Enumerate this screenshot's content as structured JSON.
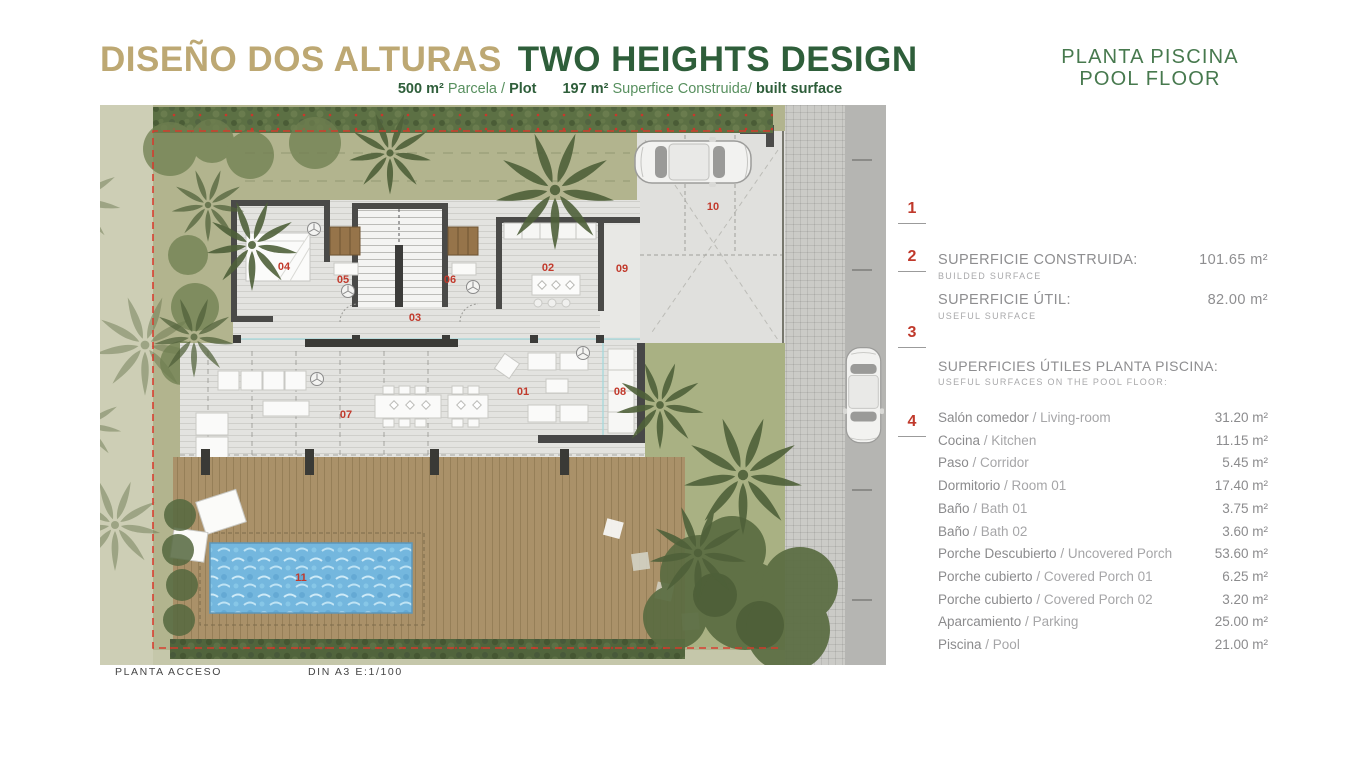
{
  "header": {
    "title_es": "DISEÑO DOS ALTURAS",
    "title_en": "TWO HEIGHTS DESIGN",
    "subtitle": {
      "plot_value": "500 m²",
      "plot_label": "Parcela /",
      "plot_label_en": "Plot",
      "built_value": "197 m²",
      "built_label": "Superfice Construida/",
      "built_label_en": "built surface"
    }
  },
  "side_header": {
    "line1": "PLANTA PISCINA",
    "line2": "POOL FLOOR"
  },
  "markers": [
    "1",
    "2",
    "3",
    "4"
  ],
  "panel": {
    "separator": " / ",
    "summary": [
      {
        "label": "SUPERFICIE CONSTRUIDA:",
        "sublabel": "BUILDED SURFACE",
        "value": "101.65 m²"
      },
      {
        "label": "SUPERFICIE ÚTIL:",
        "sublabel": "USEFUL SURFACE",
        "value": "82.00 m²"
      }
    ],
    "section": {
      "title": "SUPERFICIES ÚTILES PLANTA PISCINA:",
      "subtitle": "USEFUL SURFACES ON THE POOL FLOOR:"
    },
    "rooms": [
      {
        "es": "Salón comedor",
        "en": "Living-room",
        "value": "31.20 m²"
      },
      {
        "es": "Cocina",
        "en": "Kitchen",
        "value": "11.15 m²"
      },
      {
        "es": "Paso",
        "en": "Corridor",
        "value": "5.45 m²"
      },
      {
        "es": "Dormitorio",
        "en": "Room 01",
        "value": "17.40 m²"
      },
      {
        "es": "Baño",
        "en": "Bath 01",
        "value": "3.75 m²"
      },
      {
        "es": "Baño",
        "en": "Bath 02",
        "value": "3.60 m²"
      },
      {
        "es": "Porche Descubierto",
        "en": "Uncovered Porch",
        "value": "53.60 m²"
      },
      {
        "es": "Porche cubierto",
        "en": "Covered Porch 01",
        "value": "6.25 m²"
      },
      {
        "es": "Porche cubierto",
        "en": "Covered Porch 02",
        "value": "3.20 m²"
      },
      {
        "es": "Aparcamiento",
        "en": "Parking",
        "value": "25.00 m²"
      },
      {
        "es": "Piscina",
        "en": "Pool",
        "value": "21.00 m²"
      }
    ]
  },
  "plan": {
    "caption_left": "PLANTA ACCESO",
    "caption_right": "DIN A3  E:1/100",
    "room_numbers": [
      {
        "n": "01",
        "x": 423,
        "y": 290
      },
      {
        "n": "02",
        "x": 448,
        "y": 166
      },
      {
        "n": "03",
        "x": 315,
        "y": 216
      },
      {
        "n": "04",
        "x": 184,
        "y": 165
      },
      {
        "n": "05",
        "x": 243,
        "y": 178
      },
      {
        "n": "06",
        "x": 350,
        "y": 178
      },
      {
        "n": "07",
        "x": 246,
        "y": 313
      },
      {
        "n": "08",
        "x": 520,
        "y": 290
      },
      {
        "n": "09",
        "x": 522,
        "y": 167
      },
      {
        "n": "10",
        "x": 613,
        "y": 105
      },
      {
        "n": "11",
        "x": 201,
        "y": 476
      }
    ]
  },
  "colors": {
    "title_tan": "#bda873",
    "title_green": "#2e5e3a",
    "subtitle_green": "#58905f",
    "side_title_green": "#47794e",
    "marker_red": "#c0392b",
    "plan_number_red": "#c23a2c",
    "panel_gray": "#8e8e90",
    "boundary_red": "#d8392b",
    "lawn_green": "#b2b48e",
    "hedge_green": "#5c7044",
    "deck_brown": "#aa9169",
    "pool_blue": "#74b7de",
    "wall_dark": "#4a4a48"
  }
}
